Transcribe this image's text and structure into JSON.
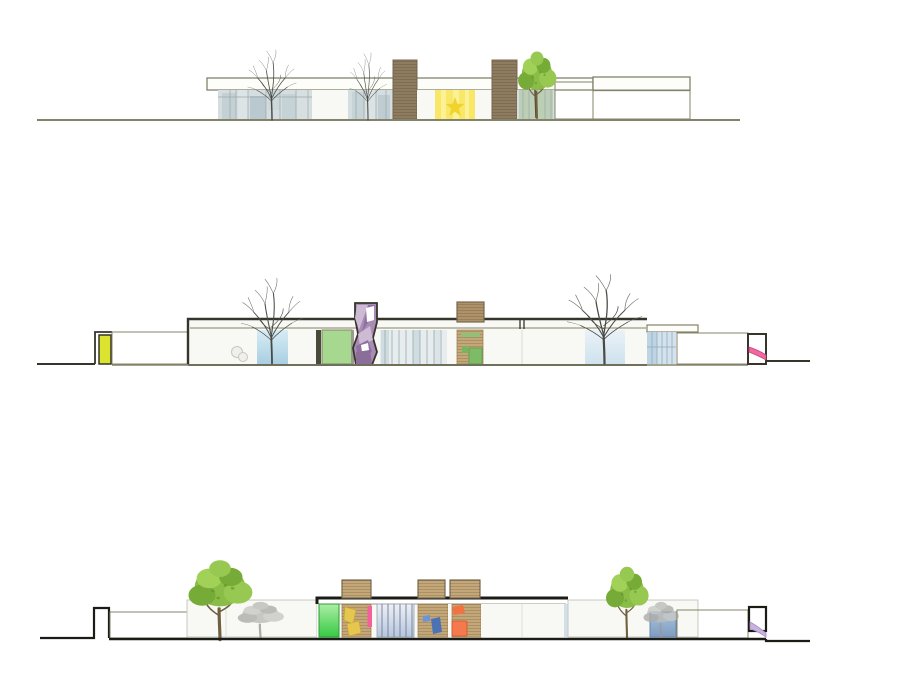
{
  "document": {
    "type": "architectural-elevation-sheet",
    "background": "#ffffff",
    "visible_text": []
  },
  "palette": {
    "outline_olive": "#83836a",
    "outline_dark": "#35352b",
    "ink_black": "#1c1c16",
    "wall_white": "#f8f8f4",
    "wall_stroke": "#c9c9c0",
    "stone_fill": "#d9d6c8",
    "stone_line": "#aeab9b",
    "glass_base": "#d4dde0",
    "glass_mullion": "#9aa8ad",
    "glass_blue": "#aed4e6",
    "glass_blue_light": "#d8ecf4",
    "wood_dark": "#8d7c60",
    "wood_mid": "#ad9269",
    "wood_light": "#c4a778",
    "yellow_room": "#f9e868",
    "yellow_star": "#f1d32e",
    "lime_panel": "#dce32f",
    "green_panel": "#a7d88f",
    "green_bright": "#3fcf4a",
    "green_accent": "#7dbb66",
    "purple_main": "#a98cb3",
    "purple_light": "#cdbad3",
    "purple_dark": "#8f72a0",
    "pink_slide": "#f2679e",
    "pink_stripe": "#f4609a",
    "lavender_slide": "#c8b2e0",
    "orange_accent": "#f2733f",
    "blue_accent": "#4a72b4",
    "yellow_accent": "#e5c64e",
    "tree_bare": "#4a4a44",
    "tree_trunk": "#71603f",
    "tree_green_1": "#8abd47",
    "tree_green_2": "#76ab38",
    "tree_green_3": "#97c851",
    "tree_green_4": "#a2d158",
    "tree_gray": "#b6b6b2"
  },
  "elevations": [
    {
      "id": "elevation-1",
      "position": "top",
      "features": [
        "ground-line",
        "roof-fascia",
        "glass-curtain-wall",
        "bare-tree",
        "wood-roof-volume",
        "yellow-playroom",
        "star-window",
        "green-tree",
        "stone-wall"
      ]
    },
    {
      "id": "elevation-2",
      "position": "middle",
      "features": [
        "ground-line",
        "lime-panel",
        "stone-wall",
        "courtyard-bare-tree",
        "glass-bay",
        "green-panel",
        "purple-climbing-tower",
        "wood-roof-box",
        "wood-panel-wall",
        "glass-curtain-wall",
        "pink-slide"
      ]
    },
    {
      "id": "elevation-3",
      "position": "bottom",
      "features": [
        "ground-line",
        "garden-post",
        "stone-wall",
        "courtyard-wall",
        "green-tree",
        "tree-shadow",
        "green-panel",
        "wood-roof-box",
        "play-furniture",
        "glass-curtain-wall",
        "blue-glass-door",
        "lavender-slide"
      ]
    }
  ]
}
